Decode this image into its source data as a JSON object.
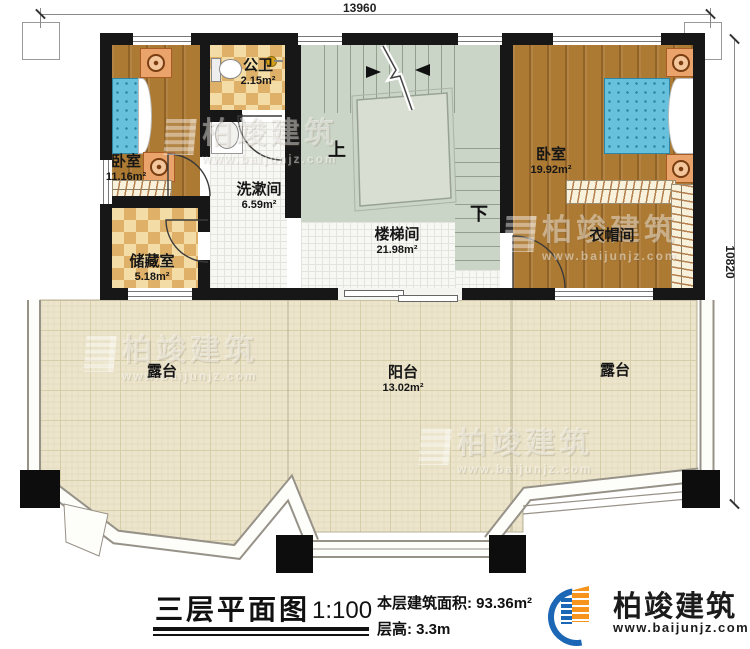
{
  "dims": {
    "top": "13960",
    "right": "10820"
  },
  "rooms": {
    "bedroom_left": {
      "name": "卧室",
      "area": "11.16m²"
    },
    "bathroom": {
      "name": "公卫",
      "area": "2.15m²"
    },
    "washroom": {
      "name": "洗漱间",
      "area": "6.59m²"
    },
    "stairwell": {
      "name": "楼梯间",
      "area": "21.98m²"
    },
    "storage": {
      "name": "储藏室",
      "area": "5.18m²"
    },
    "bedroom_right": {
      "name": "卧室",
      "area": "19.92m²"
    },
    "cloakroom": {
      "name": "衣帽间"
    },
    "terrace_left": {
      "name": "露台"
    },
    "balcony": {
      "name": "阳台",
      "area": "13.02m²"
    },
    "terrace_right": {
      "name": "露台"
    }
  },
  "stairs": {
    "up": "上",
    "down": "下"
  },
  "title_block": {
    "title": "三层平面图",
    "scale": "1:100",
    "floor_area": "本层建筑面积: 93.36m²",
    "floor_height": "层高: 3.3m"
  },
  "brand": {
    "name": "柏竣建筑",
    "website": "www.baijunjz.com"
  },
  "colors": {
    "wall": "#171717",
    "wood_floor": "#ad7a33",
    "tile_checker": "#dfb068",
    "stair_floor": "#cbd5c7",
    "terrace_floor": "#ece5cb",
    "bed": "#67c1dd",
    "brand_blue": "#1b66b5",
    "brand_orange": "#f7941d"
  }
}
